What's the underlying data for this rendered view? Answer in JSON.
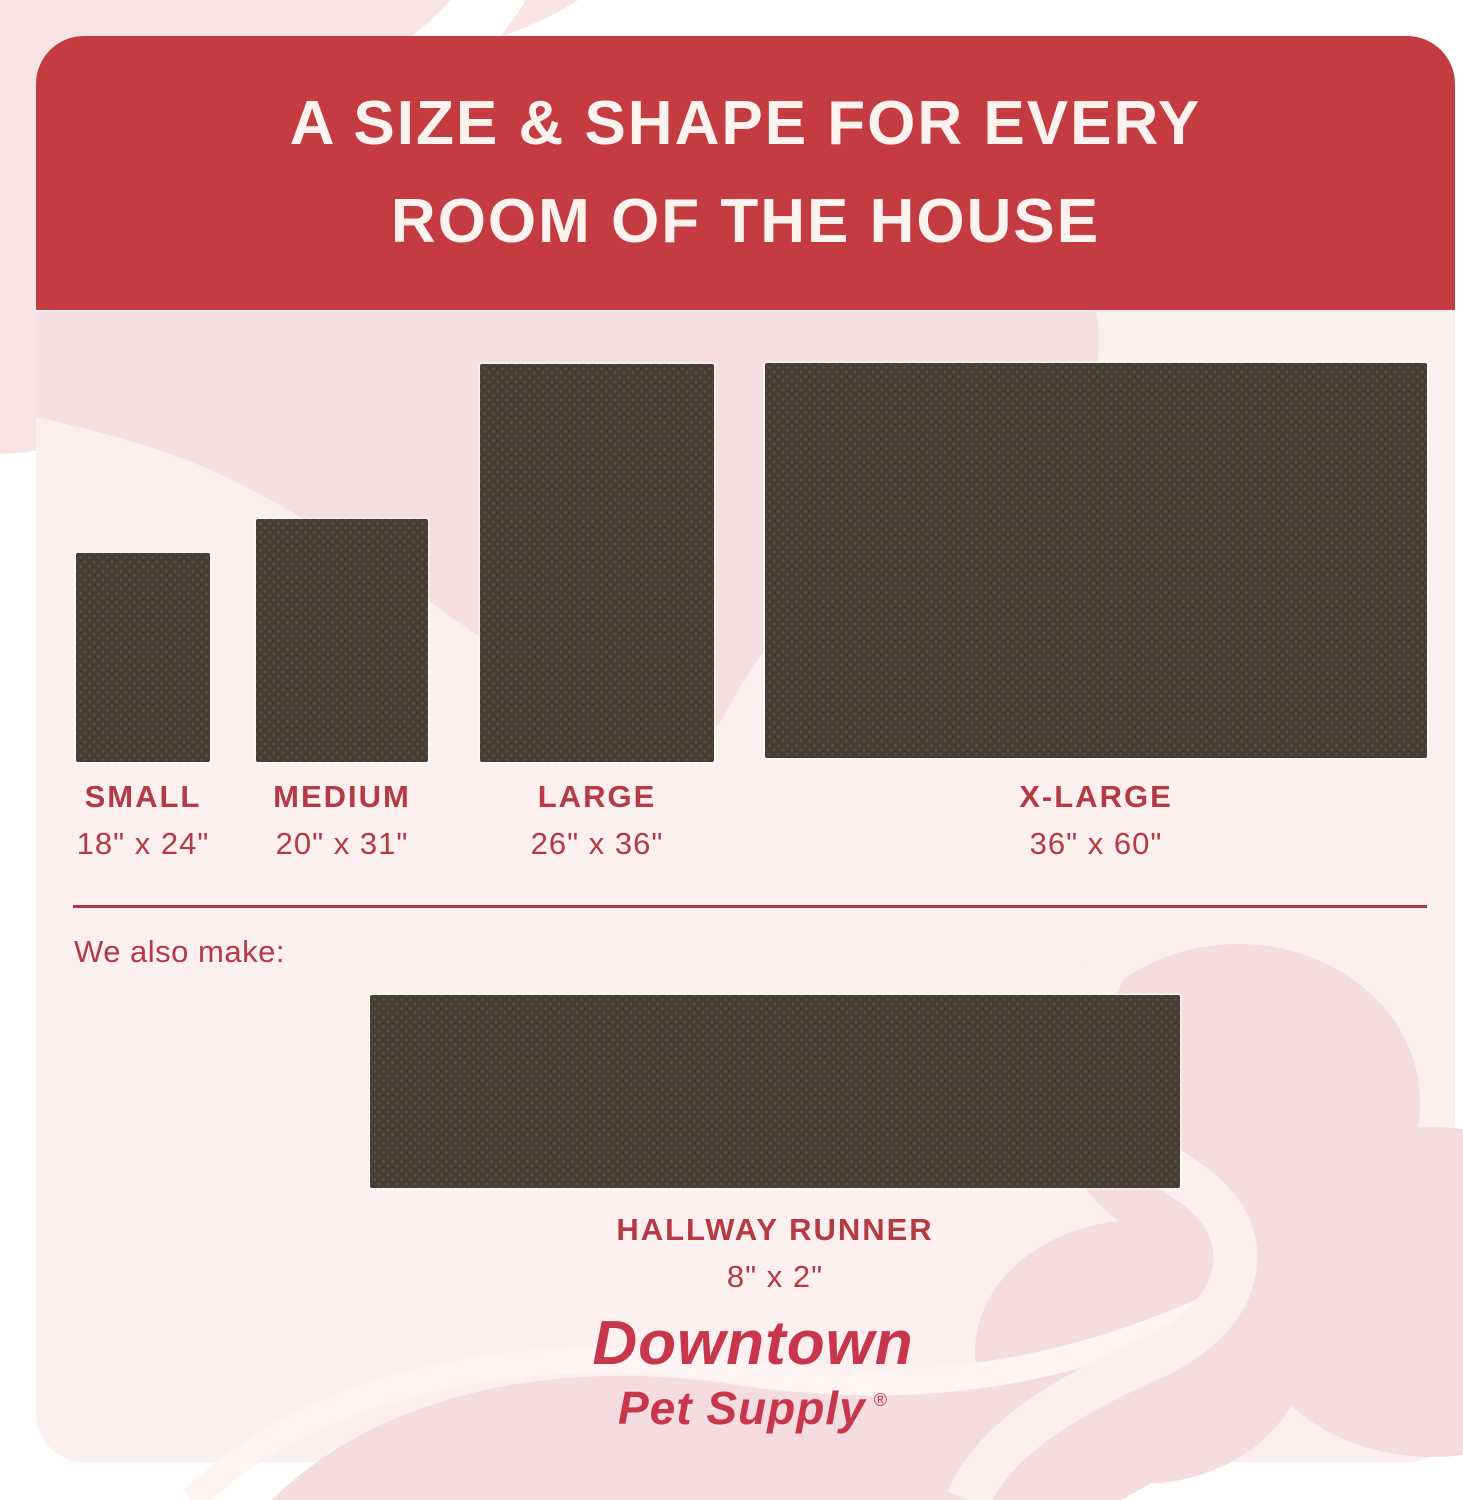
{
  "header": {
    "title_line1": "A SIZE & SHAPE FOR EVERY",
    "title_line2": "ROOM OF THE HOUSE"
  },
  "sizes": [
    {
      "name": "SMALL",
      "dimensions": "18\" x 24\""
    },
    {
      "name": "MEDIUM",
      "dimensions": "20\" x 31\""
    },
    {
      "name": "LARGE",
      "dimensions": "26\" x 36\""
    },
    {
      "name": "X-LARGE",
      "dimensions": "36\" x 60\""
    }
  ],
  "also_make": {
    "intro": "We also make:",
    "name": "HALLWAY RUNNER",
    "dimensions": "8\" x 2\""
  },
  "brand": {
    "name": "Downtown",
    "line2": "Pet Supply",
    "registered_mark": "®"
  },
  "colors": {
    "banner_red": "#c43b42",
    "heading_text": "#fdf3ee",
    "label_red": "#b43b43",
    "divider_red": "#a23d43",
    "rug_brown": "#473e33",
    "rug_dot": "#57503e",
    "card_pink": "#fbeff0",
    "blob_pink": "#f6dfe2",
    "corner_pink": "#f8e3e5",
    "logo_red": "#c7364a"
  }
}
